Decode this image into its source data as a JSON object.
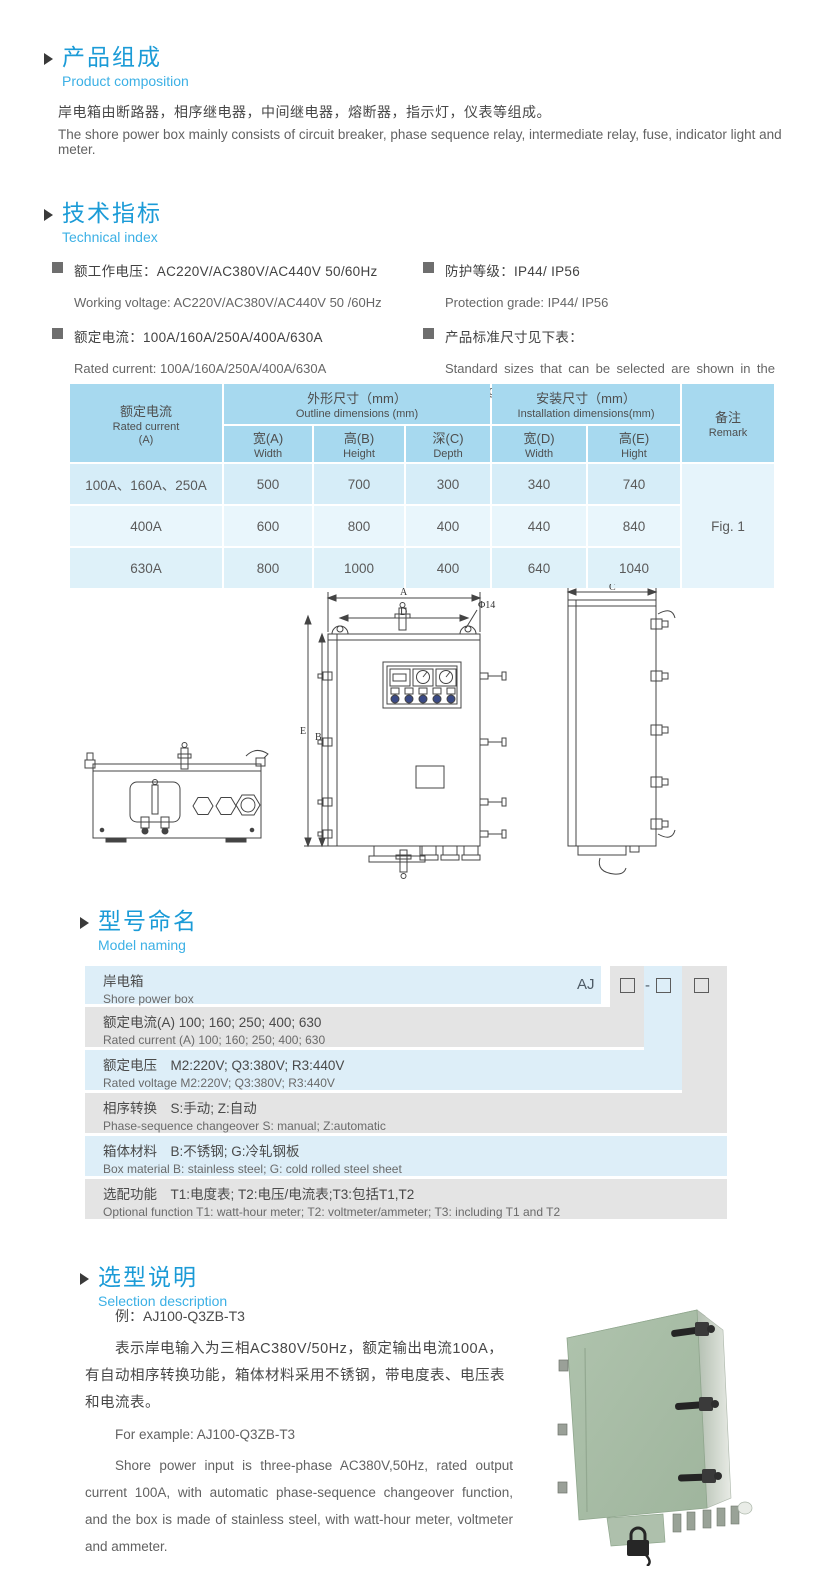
{
  "colors": {
    "accent_blue": "#1b9bd7",
    "subtitle_blue": "#3cb0e5",
    "table_header_blue": "#a7d9ef",
    "row_blue_dark": "#d6edf8",
    "row_blue_light": "#e9f6fc",
    "naming_blue": "#ddeef8",
    "naming_gray": "#e4e4e4",
    "product_green": "#a8bea6"
  },
  "composition": {
    "title_zh": "产品组成",
    "title_en": "Product composition",
    "body_zh": "岸电箱由断路器，相序继电器，中间继电器，熔断器，指示灯，仪表等组成。",
    "body_en": "The shore power box mainly consists of circuit breaker, phase sequence relay, intermediate relay, fuse, indicator light and meter."
  },
  "technical": {
    "title_zh": "技术指标",
    "title_en": "Technical index",
    "specs": [
      {
        "zh": "额工作电压：AC220V/AC380V/AC440V 50/60Hz",
        "en": "Working voltage: AC220V/AC380V/AC440V 50 /60Hz"
      },
      {
        "zh": "额定电流：100A/160A/250A/400A/630A",
        "en": "Rated current: 100A/160A/250A/400A/630A"
      },
      {
        "zh": "防护等级：IP44/ IP56",
        "en": "Protection grade: IP44/ IP56"
      },
      {
        "zh": "产品标准尺寸见下表：",
        "en": "Standard sizes that can be selected are shown in the following table"
      }
    ]
  },
  "dim_table": {
    "col_current_zh": "额定电流",
    "col_current_en": "Rated current",
    "col_current_unit": "(A)",
    "outline_zh": "外形尺寸（mm）",
    "outline_en": "Outline dimensions (mm)",
    "install_zh": "安装尺寸（mm）",
    "install_en": "Installation dimensions(mm)",
    "remark_zh": "备注",
    "remark_en": "Remark",
    "sub": [
      {
        "zh": "宽(A)",
        "en": "Width"
      },
      {
        "zh": "高(B)",
        "en": "Height"
      },
      {
        "zh": "深(C)",
        "en": "Depth"
      },
      {
        "zh": "宽(D)",
        "en": "Width"
      },
      {
        "zh": "高(E)",
        "en": "Hight"
      }
    ],
    "rows": [
      {
        "current": "100A、160A、250A",
        "w": "500",
        "h": "700",
        "d": "300",
        "iw": "340",
        "ih": "740"
      },
      {
        "current": "400A",
        "w": "600",
        "h": "800",
        "d": "400",
        "iw": "440",
        "ih": "840"
      },
      {
        "current": "630A",
        "w": "800",
        "h": "1000",
        "d": "400",
        "iw": "640",
        "ih": "1040"
      }
    ],
    "remark_value": "Fig. 1"
  },
  "drawing": {
    "label_a": "A",
    "label_d": "D",
    "label_phi": "Φ14",
    "label_e": "E",
    "label_b": "B",
    "label_c": "C"
  },
  "naming": {
    "title_zh": "型号命名",
    "title_en": "Model naming",
    "code": {
      "prefix": "AJ",
      "dash": "-"
    },
    "rows": [
      {
        "zh": "岸电箱",
        "en": "Shore power box"
      },
      {
        "zh": "额定电流(A)  100; 160; 250; 400; 630",
        "en": "Rated current (A) 100; 160; 250; 400; 630"
      },
      {
        "zh": "额定电压　M2:220V;  Q3:380V;  R3:440V",
        "en": "Rated voltage  M2:220V;  Q3:380V;  R3:440V"
      },
      {
        "zh": "相序转换　S:手动; Z:自动",
        "en": "Phase-sequence changeover  S: manual;  Z:automatic"
      },
      {
        "zh": "箱体材料　B:不锈钢;  G:冷轧钢板",
        "en": "Box material   B: stainless steel; G: cold rolled steel sheet"
      },
      {
        "zh": "选配功能　T1:电度表;  T2:电压/电流表;T3:包括T1,T2",
        "en": "Optional function  T1: watt-hour meter; T2: voltmeter/ammeter; T3: including T1 and T2"
      }
    ]
  },
  "selection": {
    "title_zh": "选型说明",
    "title_en": "Selection description",
    "example_zh": "例：AJ100-Q3ZB-T3",
    "body_zh": "表示岸电输入为三相AC380V/50Hz，额定输出电流100A，有自动相序转换功能，箱体材料采用不锈钢，带电度表、电压表和电流表。",
    "example_en": "For example: AJ100-Q3ZB-T3",
    "body_en": "Shore power input is three-phase AC380V,50Hz, rated output current 100A, with automatic phase-sequence changeover function, and the box is made of stainless steel, with watt-hour meter, voltmeter and ammeter."
  }
}
